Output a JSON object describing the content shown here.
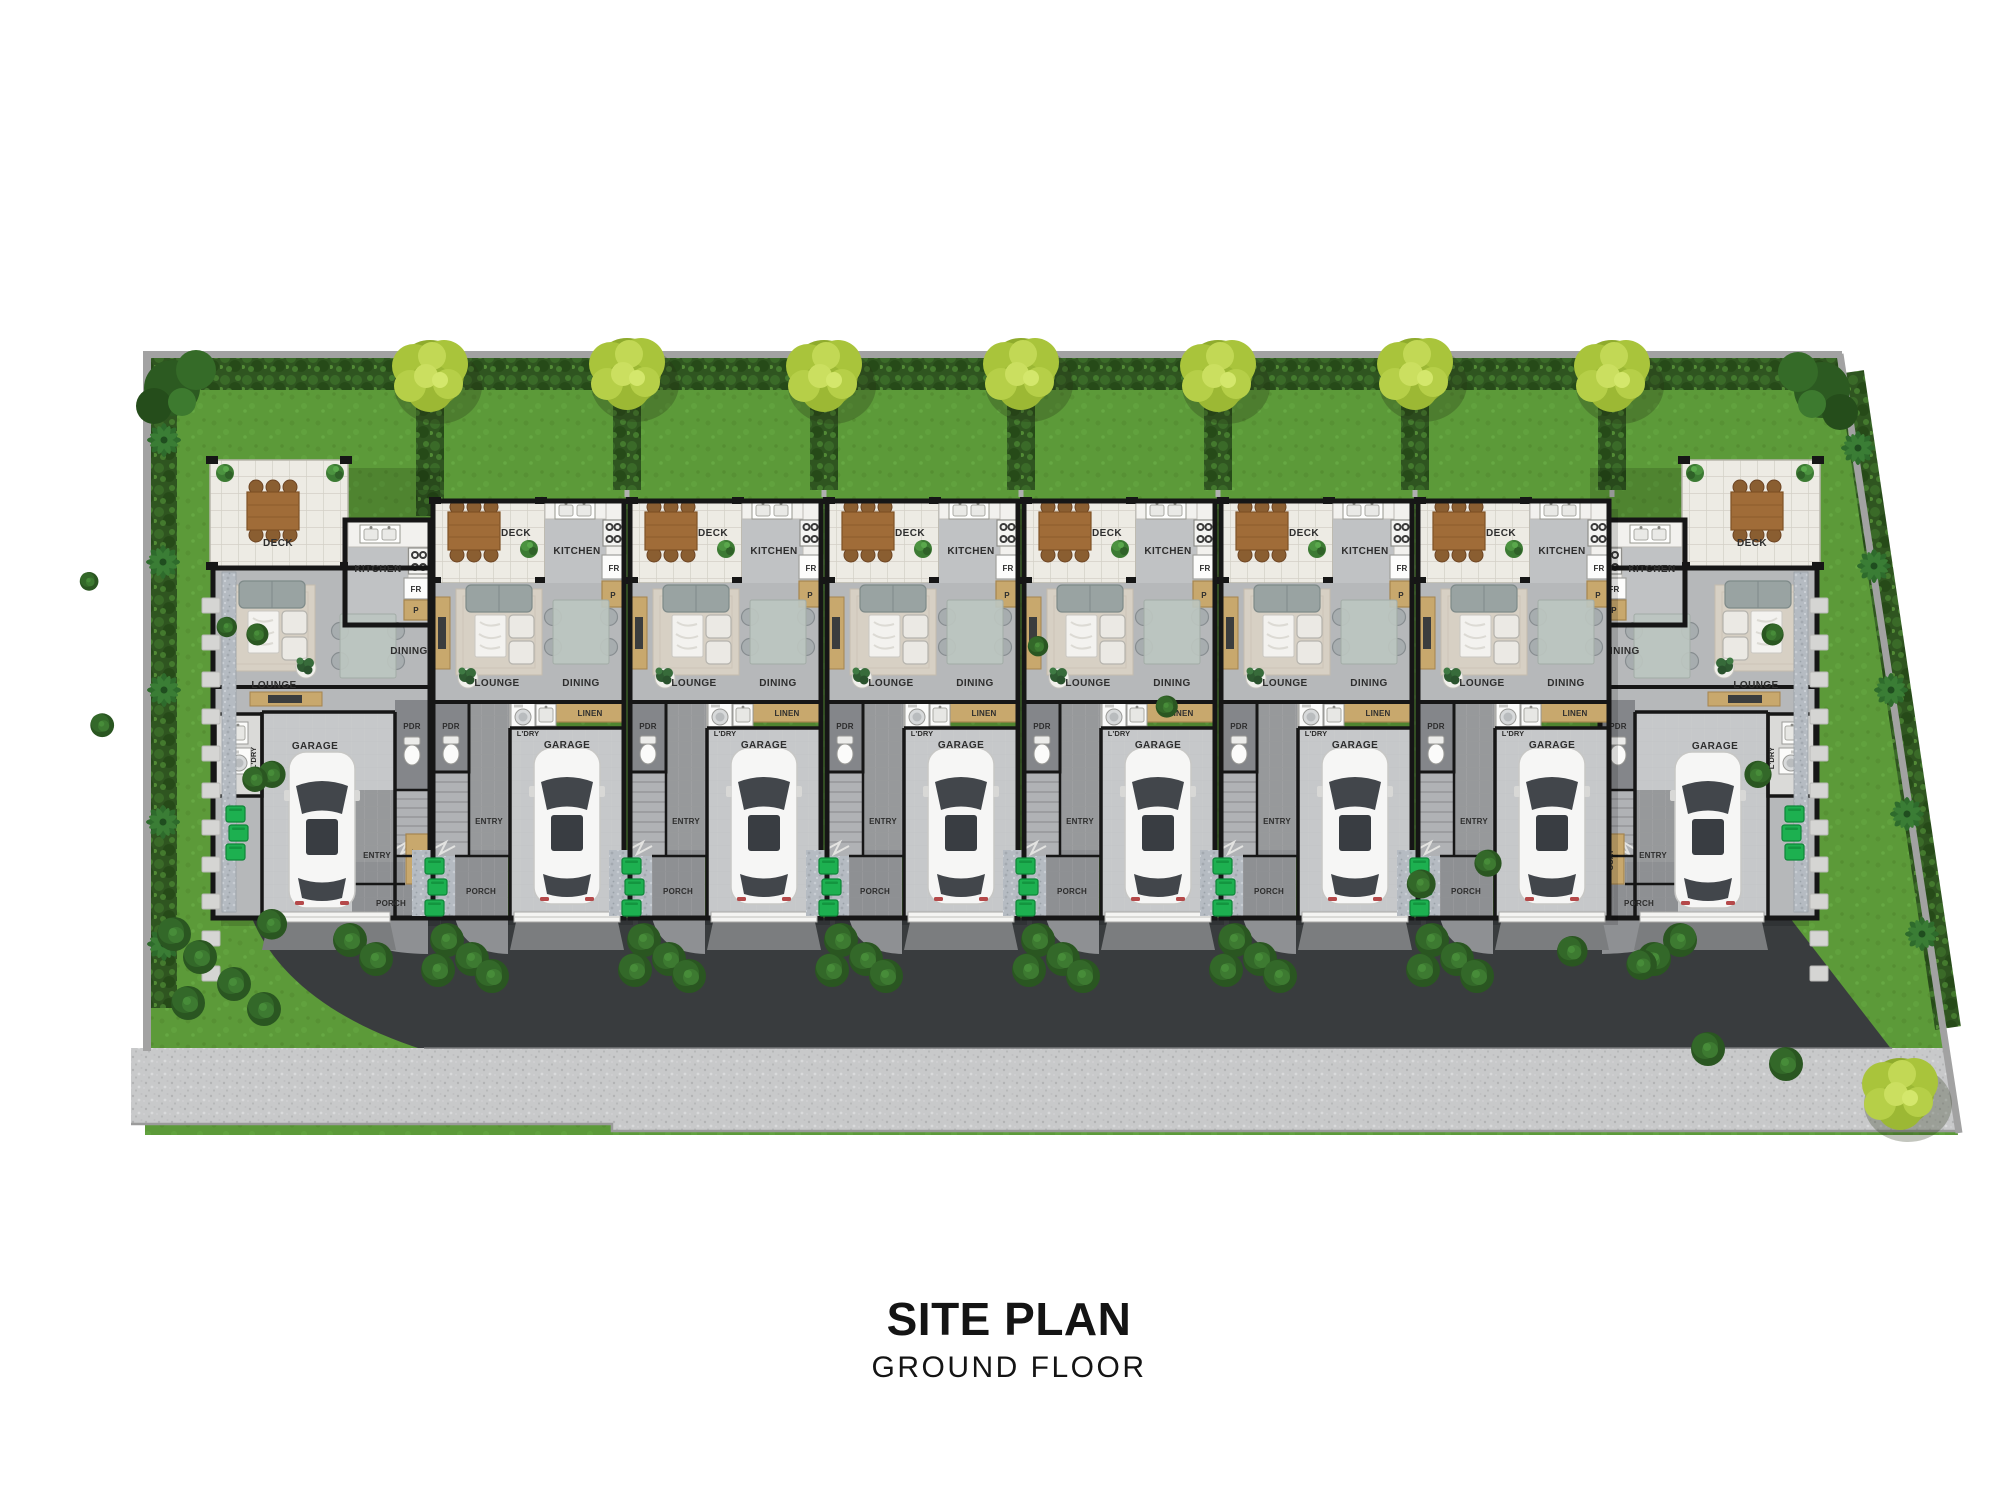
{
  "title": {
    "main": "SITE PLAN",
    "sub": "GROUND FLOOR"
  },
  "rooms": {
    "deck": "DECK",
    "kitchen": "KITCHEN",
    "fridge": "FR",
    "pantry": "P",
    "lounge": "LOUNGE",
    "dining": "DINING",
    "linen": "LINEN",
    "laundry": "L'DRY",
    "powder": "PDR",
    "entry": "ENTRY",
    "coat": "COAT",
    "porch": "PORCH",
    "garage": "GARAGE"
  },
  "units": [
    {
      "id": 1,
      "type": "end-left",
      "x": 210
    },
    {
      "id": 2,
      "type": "mid",
      "x": 430
    },
    {
      "id": 3,
      "type": "mid",
      "x": 627
    },
    {
      "id": 4,
      "type": "mid",
      "x": 824
    },
    {
      "id": 5,
      "type": "mid",
      "x": 1021
    },
    {
      "id": 6,
      "type": "mid",
      "x": 1218
    },
    {
      "id": 7,
      "type": "mid",
      "x": 1415
    },
    {
      "id": 8,
      "type": "end-right",
      "x": 1612
    }
  ],
  "palette": {
    "lawn": "#5c9a39",
    "hedge": "#2f5520",
    "tree": "#a9c43b",
    "deck_tile": "#edebe4",
    "interior_floor": "#b6b8ba",
    "garage_floor": "#c6c8ca",
    "porch_floor": "#8e9093",
    "asphalt": "#393c3e",
    "footpath": "#c8c9ca",
    "wall": "#161616",
    "cabinet_tan": "#c8a86d",
    "bin_green": "#1db050",
    "wood_table": "#a06c38"
  }
}
